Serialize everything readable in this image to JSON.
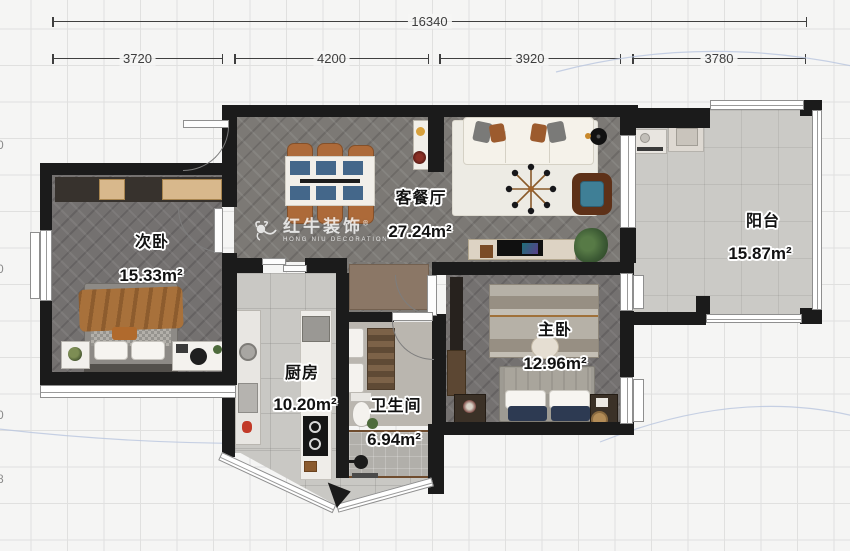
{
  "watermark": {
    "brand": "红牛装饰",
    "registered": "®",
    "subtitle": "HONG NIU DECORATION"
  },
  "dimensions": {
    "total": "16340",
    "segments": [
      "3720",
      "4200",
      "3920",
      "3780"
    ],
    "edge_fragments": [
      "0",
      "0",
      "0",
      "8"
    ]
  },
  "rooms": [
    {
      "id": "secondary-bedroom",
      "name": "次卧",
      "area": "15.33m²"
    },
    {
      "id": "living-dining",
      "name": "客餐厅",
      "area": "27.24m²"
    },
    {
      "id": "balcony",
      "name": "阳台",
      "area": "15.87m²"
    },
    {
      "id": "kitchen",
      "name": "厨房",
      "area": "10.20m²"
    },
    {
      "id": "bathroom",
      "name": "卫生间",
      "area": "6.94m²"
    },
    {
      "id": "master-bedroom",
      "name": "主卧",
      "area": "12.96m²"
    }
  ],
  "colors": {
    "wall": "#1b1b1b",
    "wood_floor": "#7c7975",
    "tile_floor": "#c9c8c4",
    "wardrobe_panel": "#d8b88c",
    "dining_chair": "#ad6a39",
    "accent_blanket": "#a8713b"
  }
}
